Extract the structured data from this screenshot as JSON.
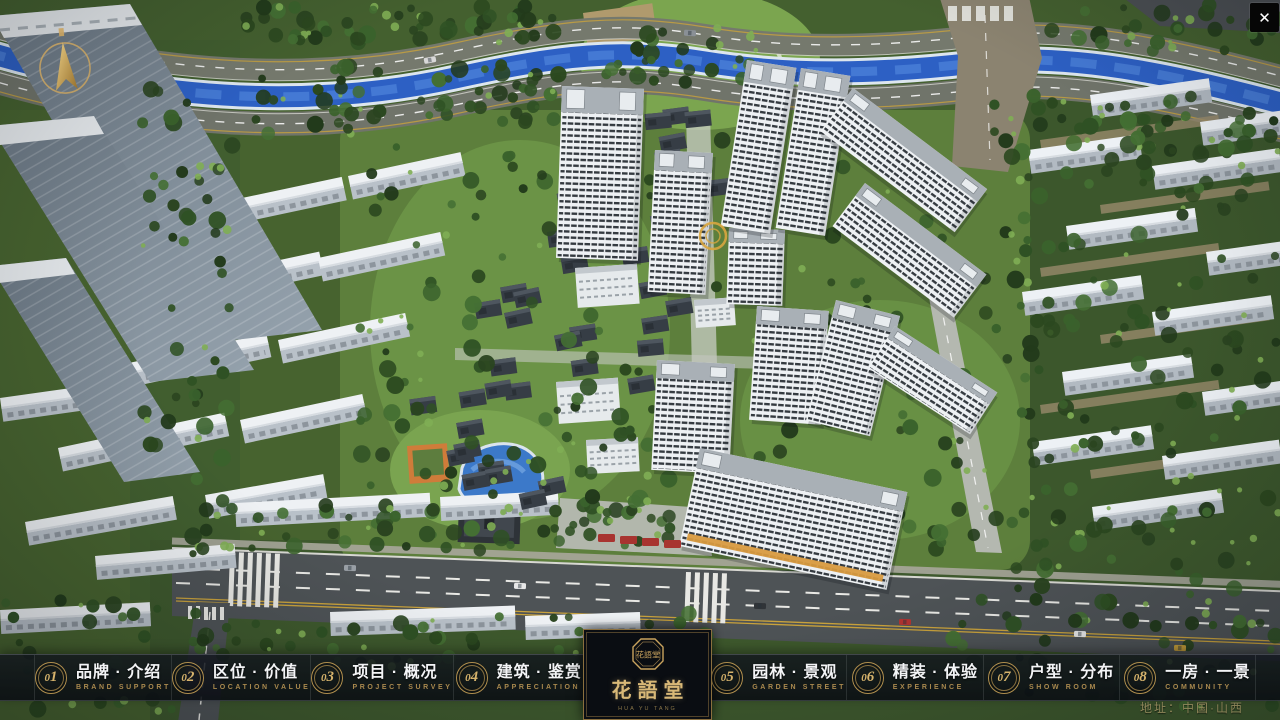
{
  "titlebar": {
    "close_glyph": "✕"
  },
  "logo": {
    "title": "花語堂",
    "seal_text": "花語堂",
    "caption": "HUA YU TANG"
  },
  "footer": {
    "address": "地址：中国·山西"
  },
  "colors": {
    "accent_gold": "#C9A35E",
    "navbar_bg": "#10141C",
    "river_blue": "#2D60C4"
  },
  "nav": {
    "items": [
      {
        "num": "01",
        "label": "品牌 · 介绍",
        "sub": "BRAND SUPPORT"
      },
      {
        "num": "02",
        "label": "区位 · 价值",
        "sub": "LOCATION VALUE"
      },
      {
        "num": "03",
        "label": "项目 · 概况",
        "sub": "PROJECT SURVEY"
      },
      {
        "num": "04",
        "label": "建筑 · 鉴赏",
        "sub": "APPRECIATION"
      },
      {
        "num": "05",
        "label": "园林 · 景观",
        "sub": "GARDEN STREET"
      },
      {
        "num": "06",
        "label": "精装 · 体验",
        "sub": "EXPERIENCE"
      },
      {
        "num": "07",
        "label": "户型 · 分布",
        "sub": "SHOW ROOM"
      },
      {
        "num": "08",
        "label": "一房 · 一景",
        "sub": "COMMUNITY"
      }
    ]
  }
}
